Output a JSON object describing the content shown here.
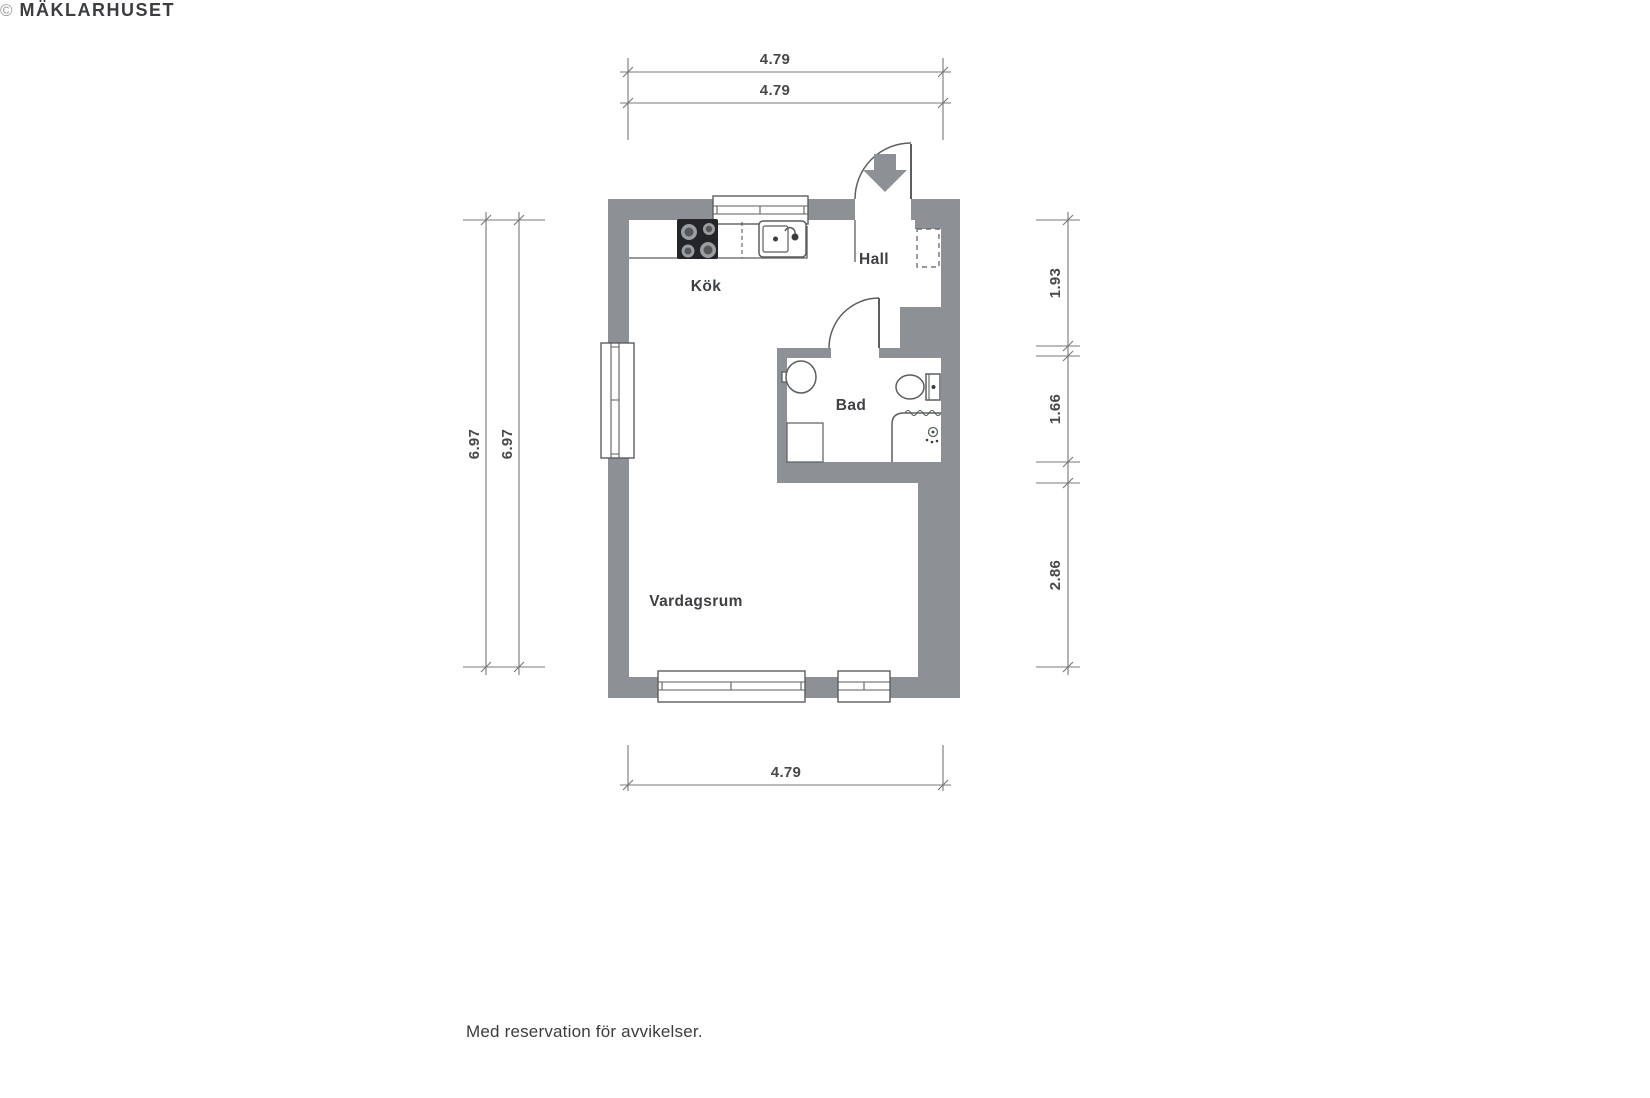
{
  "plan": {
    "rooms": {
      "kitchen": "Kök",
      "hall": "Hall",
      "bathroom": "Bad",
      "living_room": "Vardagsrum"
    },
    "dimensions": {
      "top_outer": "4.79",
      "top_inner": "4.79",
      "left_outer": "6.97",
      "left_inner": "6.97",
      "right_hall": "1.93",
      "right_bath": "1.66",
      "right_living": "2.86",
      "bottom": "4.79"
    }
  },
  "colors": {
    "wall": "#8d9195",
    "fixture_line": "#5b5e61",
    "dimension_line": "#75787b",
    "dimension_text": "#474849",
    "label_text": "#3e4043"
  },
  "footer": {
    "disclaimer": "Med reservation för avvikelser.",
    "copyright_symbol": "©",
    "copyright_name": "MÄKLARHUSET"
  }
}
